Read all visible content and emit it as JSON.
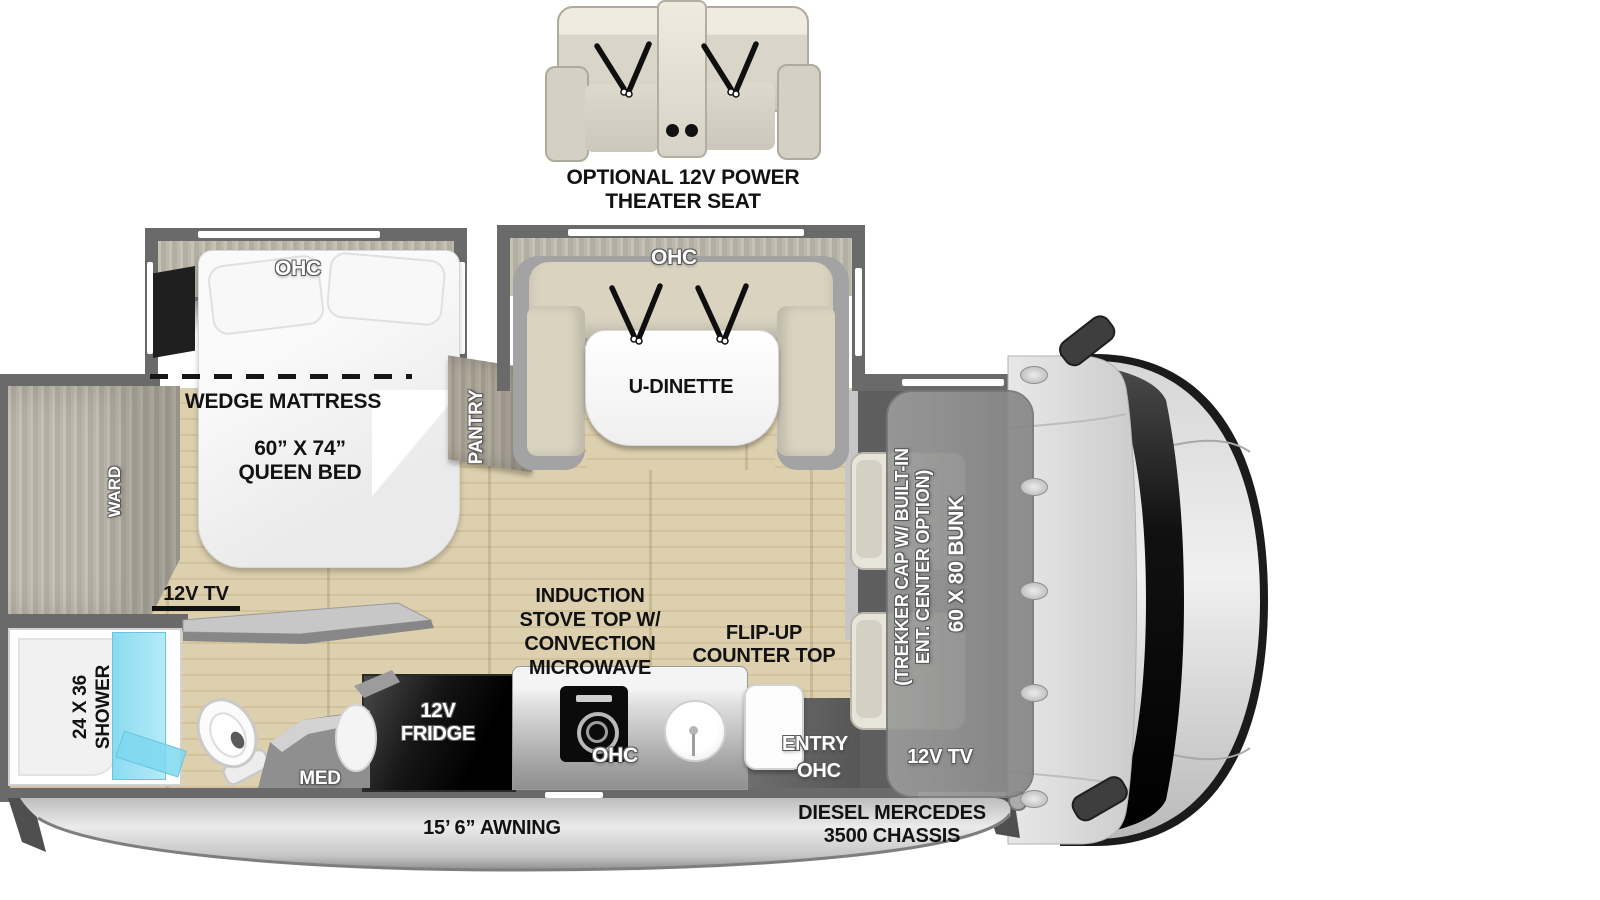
{
  "theater_seat": {
    "label_line1": "OPTIONAL 12V POWER",
    "label_line2": "THEATER SEAT"
  },
  "bedroom": {
    "ohc": "OHC",
    "wedge": "WEDGE MATTRESS",
    "bed_size": "60” X 74”",
    "bed_name": "QUEEN BED",
    "ward": "WARD",
    "pantry": "PANTRY",
    "tv": "12V TV"
  },
  "dinette": {
    "ohc": "OHC",
    "name": "U-DINETTE"
  },
  "bathroom": {
    "shower_size": "24 X 36",
    "shower": "SHOWER",
    "med": "MED"
  },
  "kitchen": {
    "fridge_line1": "12V",
    "fridge_line2": "FRIDGE",
    "stove_lines": [
      "INDUCTION",
      "STOVE TOP W/",
      "CONVECTION",
      "MICROWAVE"
    ],
    "ohc": "OHC",
    "flip_line1": "FLIP-UP",
    "flip_line2": "COUNTER TOP"
  },
  "entry": {
    "label": "ENTRY",
    "ohc": "OHC"
  },
  "bunk": {
    "trekker_line1": "(TREKKER CAP W/ BUILT-IN",
    "trekker_line2": "ENT. CENTER OPTION)",
    "size": "60 X 80 BUNK",
    "tv": "12V TV"
  },
  "chassis": {
    "awning": "15’ 6” AWNING",
    "engine_line1": "DIESEL MERCEDES",
    "engine_line2": "3500 CHASSIS"
  },
  "colors": {
    "wall": "#6a6a6a",
    "floor": "#ddd0ae",
    "cushion": "#d7d1be",
    "shower_glass": "#7fd9ef",
    "bunk": "#8f8f8f",
    "appliance_black": "#0d0d0d",
    "awning_silver": "#d9d9d9"
  }
}
